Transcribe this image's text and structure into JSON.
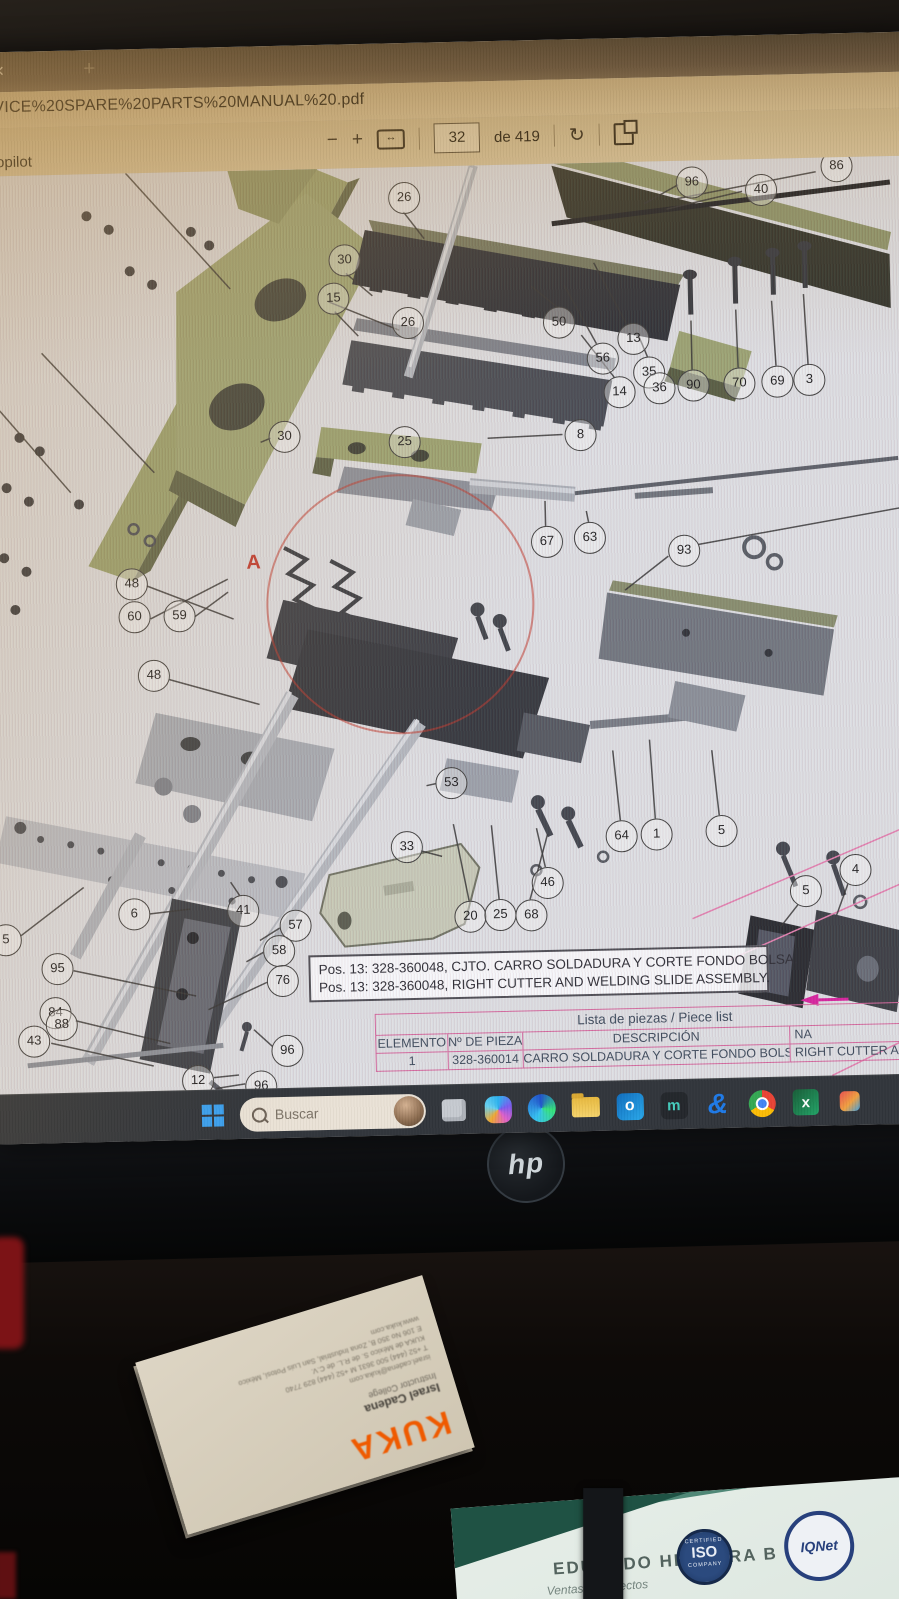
{
  "browser": {
    "tab": {
      "close_icon": "×",
      "new_tab_icon": "+"
    },
    "url_text": "RVICE%20SPARE%20PARTS%20MANUAL%20.pdf",
    "copilot_label": "Copilot",
    "pdf_toolbar": {
      "zoom_out": "−",
      "zoom_in": "+",
      "fit_width": "↔",
      "page_current": "32",
      "page_total": "de 419",
      "rotate": "↻"
    }
  },
  "diagram": {
    "detail_label": "A",
    "balloons": [
      {
        "n": "26",
        "x": 427,
        "y": 30
      },
      {
        "n": "30",
        "x": 366,
        "y": 91
      },
      {
        "n": "15",
        "x": 354,
        "y": 129
      },
      {
        "n": "26",
        "x": 428,
        "y": 155
      },
      {
        "n": "50",
        "x": 579,
        "y": 158
      },
      {
        "n": "96",
        "x": 715,
        "y": 21
      },
      {
        "n": "40",
        "x": 784,
        "y": 30
      },
      {
        "n": "86",
        "x": 860,
        "y": 8
      },
      {
        "n": "13",
        "x": 653,
        "y": 176
      },
      {
        "n": "56",
        "x": 622,
        "y": 195
      },
      {
        "n": "14",
        "x": 638,
        "y": 229
      },
      {
        "n": "35",
        "x": 668,
        "y": 210
      },
      {
        "n": "36",
        "x": 678,
        "y": 226
      },
      {
        "n": "90",
        "x": 712,
        "y": 224
      },
      {
        "n": "70",
        "x": 758,
        "y": 223
      },
      {
        "n": "69",
        "x": 796,
        "y": 222
      },
      {
        "n": "3",
        "x": 828,
        "y": 221
      },
      {
        "n": "30",
        "x": 302,
        "y": 266
      },
      {
        "n": "25",
        "x": 422,
        "y": 274
      },
      {
        "n": "8",
        "x": 598,
        "y": 271
      },
      {
        "n": "67",
        "x": 562,
        "y": 377
      },
      {
        "n": "63",
        "x": 605,
        "y": 374
      },
      {
        "n": "93",
        "x": 699,
        "y": 389
      },
      {
        "n": "48",
        "x": 146,
        "y": 410
      },
      {
        "n": "60",
        "x": 148,
        "y": 443
      },
      {
        "n": "59",
        "x": 193,
        "y": 443
      },
      {
        "n": "48",
        "x": 166,
        "y": 502
      },
      {
        "n": "53",
        "x": 461,
        "y": 616
      },
      {
        "n": "33",
        "x": 415,
        "y": 679
      },
      {
        "n": "64",
        "x": 630,
        "y": 673
      },
      {
        "n": "1",
        "x": 665,
        "y": 672
      },
      {
        "n": "5",
        "x": 730,
        "y": 670
      },
      {
        "n": "46",
        "x": 555,
        "y": 718
      },
      {
        "n": "20",
        "x": 477,
        "y": 750
      },
      {
        "n": "25",
        "x": 507,
        "y": 749
      },
      {
        "n": "68",
        "x": 538,
        "y": 750
      },
      {
        "n": "5",
        "x": 813,
        "y": 732
      },
      {
        "n": "4",
        "x": 863,
        "y": 712
      },
      {
        "n": "6",
        "x": 141,
        "y": 740
      },
      {
        "n": "41",
        "x": 250,
        "y": 739
      },
      {
        "n": "57",
        "x": 302,
        "y": 755
      },
      {
        "n": "58",
        "x": 285,
        "y": 780
      },
      {
        "n": "95",
        "x": 63,
        "y": 793
      },
      {
        "n": "76",
        "x": 288,
        "y": 810
      },
      {
        "n": "84",
        "x": 60,
        "y": 837
      },
      {
        "n": "88",
        "x": 66,
        "y": 849
      },
      {
        "n": "43",
        "x": 38,
        "y": 865
      },
      {
        "n": "96",
        "x": 291,
        "y": 880
      },
      {
        "n": "96",
        "x": 264,
        "y": 915
      },
      {
        "n": "12",
        "x": 201,
        "y": 908
      },
      {
        "n": "5",
        "x": 12,
        "y": 763
      }
    ],
    "leader_lines": [
      [
        840,
        14,
        700,
        38
      ],
      [
        766,
        32,
        690,
        48
      ],
      [
        702,
        24,
        668,
        42
      ],
      [
        647,
        161,
        616,
        100
      ],
      [
        617,
        181,
        586,
        122
      ],
      [
        634,
        215,
        602,
        172
      ],
      [
        668,
        196,
        656,
        166
      ],
      [
        712,
        209,
        712,
        160
      ],
      [
        758,
        208,
        757,
        150
      ],
      [
        796,
        207,
        793,
        142
      ],
      [
        828,
        206,
        825,
        136
      ],
      [
        579,
        144,
        553,
        122
      ],
      [
        427,
        45,
        447,
        72
      ],
      [
        368,
        105,
        394,
        128
      ],
      [
        356,
        143,
        379,
        168
      ],
      [
        420,
        163,
        350,
        133
      ],
      [
        289,
        268,
        279,
        272
      ],
      [
        581,
        271,
        506,
        273
      ],
      [
        562,
        362,
        562,
        337
      ],
      [
        605,
        359,
        603,
        348
      ],
      [
        684,
        395,
        640,
        428
      ],
      [
        714,
        384,
        916,
        352
      ],
      [
        162,
        413,
        248,
        448
      ],
      [
        165,
        446,
        243,
        408
      ],
      [
        209,
        445,
        243,
        421
      ],
      [
        182,
        507,
        272,
        534
      ],
      [
        447,
        617,
        437,
        619
      ],
      [
        430,
        684,
        451,
        690
      ],
      [
        554,
        703,
        546,
        664
      ],
      [
        477,
        735,
        463,
        658
      ],
      [
        507,
        734,
        501,
        660
      ],
      [
        538,
        735,
        557,
        670
      ],
      [
        630,
        658,
        624,
        588
      ],
      [
        665,
        657,
        661,
        578
      ],
      [
        729,
        655,
        723,
        590
      ],
      [
        806,
        746,
        788,
        768
      ],
      [
        856,
        727,
        844,
        758
      ],
      [
        157,
        741,
        198,
        737
      ],
      [
        248,
        725,
        239,
        711
      ],
      [
        287,
        758,
        267,
        770
      ],
      [
        270,
        782,
        253,
        791
      ],
      [
        80,
        796,
        202,
        824
      ],
      [
        273,
        812,
        214,
        838
      ],
      [
        81,
        846,
        175,
        871
      ],
      [
        56,
        868,
        158,
        893
      ],
      [
        277,
        876,
        259,
        859
      ],
      [
        249,
        913,
        220,
        917
      ],
      [
        218,
        906,
        243,
        904
      ],
      [
        28,
        760,
        92,
        713
      ],
      [
        150,
        0,
        252,
        118
      ],
      [
        62,
        178,
        172,
        300
      ],
      [
        0,
        212,
        88,
        318
      ]
    ],
    "note_box": {
      "line1": "Pos. 13: 328-360048, CJTO. CARRO SOLDADURA Y CORTE FONDO BOLSA.",
      "line2": "Pos. 13: 328-360048, RIGHT CUTTER AND WELDING SLIDE ASSEMBLY."
    },
    "parts_table": {
      "title": "Lista de piezas / Piece list",
      "headers": [
        "ELEMENTO",
        "Nº DE PIEZA",
        "DESCRIPCIÓN",
        "NA"
      ],
      "rows": [
        [
          "1",
          "328-360014",
          "CARRO SOLDADURA Y CORTE FONDO BOLSA",
          "RIGHT CUTTER AN"
        ]
      ]
    }
  },
  "taskbar": {
    "search_placeholder": "Buscar",
    "icons": [
      "windows",
      "search",
      "avatar",
      "widgets",
      "copilot",
      "edge",
      "file-explorer",
      "outlook",
      "m-app",
      "blue-glyph-app",
      "chrome",
      "excel",
      "app-partial"
    ],
    "outlook_letter": "o",
    "m_letter": "m",
    "blue_glyph": "&",
    "excel_letter": "x"
  },
  "monitor": {
    "brand_logo": "hp"
  },
  "desk": {
    "kuka_card": {
      "logo": "KUKA",
      "name": "Israel Cadena",
      "title": "Instructor College",
      "email": "israel.cadena@kuka.com",
      "phone": "T +52 (444) 500 3631   M +52 (444) 829 7740",
      "company": "KUKA de México S. de R.L. de C.V.",
      "address": "E 106 No 350 B, Zona Industrial, San Luis Potosí, México",
      "web": "www.kuka.com"
    },
    "notebook": {
      "name": "EDUARDO HERRERA B",
      "subtitle": "Ventas y proyectos",
      "iso_badge": {
        "top": "CERTIFIED",
        "center": "ISO",
        "bottom": "COMPANY"
      },
      "iqnet_badge": {
        "label": "IQNet"
      }
    }
  },
  "colors": {
    "table_pink": "#d4679c",
    "kuka_orange": "#ef5a00",
    "detail_red": "#c23b2e",
    "magenta_arrow": "#d6219c"
  }
}
